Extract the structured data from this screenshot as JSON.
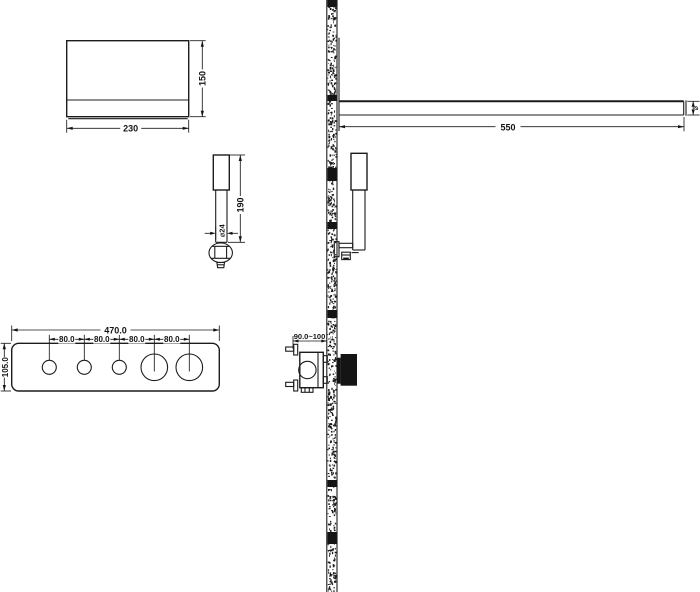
{
  "drawing": {
    "background": "#ffffff",
    "line_color": "#1c1c1c"
  },
  "labels": {
    "overhead_width": "230",
    "overhead_height": "150",
    "handshower_height": "190",
    "handshower_diameter": "⌀24",
    "panel_width": "470.0",
    "panel_height": "105.0",
    "panel_spacing": [
      "80.0",
      "80.0",
      "80.0",
      "80.0"
    ],
    "valve_depth": "90.0~100",
    "arm_length": "550",
    "arm_end_marker": "⌀"
  }
}
